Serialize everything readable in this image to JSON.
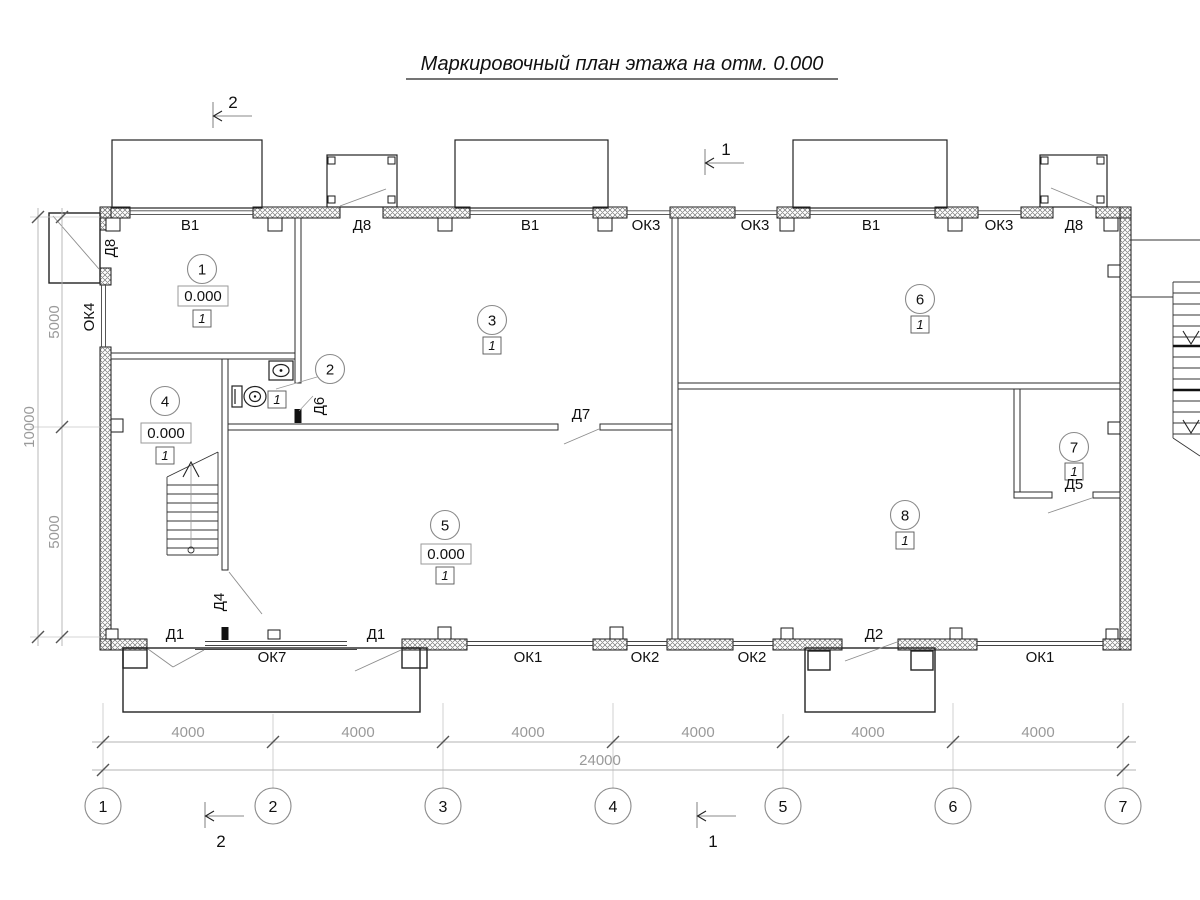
{
  "title": {
    "text": "Маркировочный план этажа на отм. 0.000"
  },
  "sections": {
    "top_left": "2",
    "top_right": "1",
    "bottom_left": "2",
    "bottom_right": "1"
  },
  "rooms": {
    "r1": {
      "num": "1",
      "elev": "0.000",
      "fin": "1"
    },
    "r2": {
      "num": "2",
      "fin": "1"
    },
    "r3": {
      "num": "3",
      "fin": "1"
    },
    "r4": {
      "num": "4",
      "elev": "0.000",
      "fin": "1"
    },
    "r5": {
      "num": "5",
      "elev": "0.000",
      "fin": "1"
    },
    "r6": {
      "num": "6",
      "fin": "1"
    },
    "r7": {
      "num": "7",
      "fin": "1"
    },
    "r8": {
      "num": "8",
      "fin": "1"
    }
  },
  "openings": {
    "top": {
      "b1a": "В1",
      "d8a": "Д8",
      "b1b": "В1",
      "ok3a": "ОК3",
      "ok3b": "ОК3",
      "b1c": "В1",
      "ok3c": "ОК3",
      "d8b": "Д8"
    },
    "left": {
      "d8": "Д8",
      "ok4": "ОК4"
    },
    "bottom": {
      "d1a": "Д1",
      "ok7": "ОК7",
      "d1b": "Д1",
      "ok1a": "ОК1",
      "ok2a": "ОК2",
      "ok2b": "ОК2",
      "d2": "Д2",
      "ok1b": "ОК1"
    },
    "interior": {
      "d6": "Д6",
      "d7": "Д7",
      "d4": "Д4",
      "d5": "Д5"
    }
  },
  "dimensions": {
    "spans": [
      "4000",
      "4000",
      "4000",
      "4000",
      "4000",
      "4000"
    ],
    "total": "24000",
    "left": {
      "top": "5000",
      "bottom": "5000",
      "total": "10000"
    }
  },
  "axes": [
    "1",
    "2",
    "3",
    "4",
    "5",
    "6",
    "7"
  ]
}
